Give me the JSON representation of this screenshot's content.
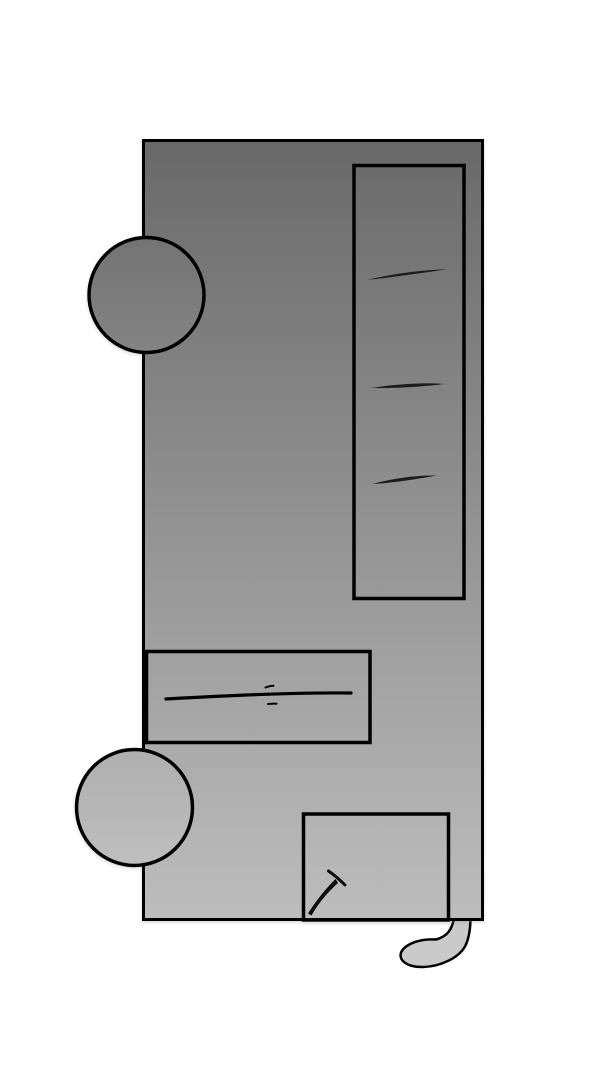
{
  "canvas": {
    "width": 600,
    "height": 1080,
    "background": "#ffffff"
  },
  "palette": {
    "outline": "#000000",
    "shadow_color": "#888888"
  },
  "parts": {
    "body": {
      "x": 143.5,
      "y": 140.5,
      "width": 339,
      "height": 779,
      "stroke_width": 3,
      "fill_top": "#696969",
      "fill_bottom": "#bdbdbd"
    },
    "display_window": {
      "x": 354,
      "y": 165.5,
      "width": 110,
      "height": 433,
      "stroke_width": 3.5,
      "fill": "none"
    },
    "shelf_marks": {
      "color": "#1a1a1a",
      "paths": [
        "M 367 280 C 392 274 423 269.5 447 269.5 C 423 272.5 392 277.5 367 280 Z",
        "M 371 388 C 397 384 426 382.5 444 384 C 425 386.5 396 388.5 371 388 Z",
        "M 372 484 C 392 478.5 417 475 437 475.5 C 417 479 393 483 372 484 Z"
      ]
    },
    "slot_panel": {
      "x": 146.5,
      "y": 651.5,
      "width": 223.5,
      "height": 91,
      "stroke_width": 3.5,
      "fill": "none",
      "line_path": "M 166 699 C 235 695 305 692.5 351 693",
      "line_width": 3.2,
      "tick_top_path": "M 265.5 687.5 C 268.5 686.3 271.5 685.7 273.5 685.7",
      "tick_bottom_path": "M 268 704 C 271 703.7 274 703.4 276.5 703.7",
      "tick_width": 2
    },
    "hatch": {
      "x": 303.5,
      "y": 814,
      "width": 145,
      "height": 106,
      "stroke_width": 3.5,
      "fill": "none"
    },
    "pushpin": {
      "color": "#0a0a0a",
      "body_path": "M 308 913.5 C 316.5 900 326 888.5 335.5 879 C 336.5 880.5 337.5 882 338 883 C 329.5 890.5 319 902 311.5 915.5 Z",
      "head_path": "M 328.5 871 C 333.5 874.5 339.5 879.5 345 885",
      "head_width": 3
    },
    "knob_top": {
      "cx": 146.5,
      "cy": 295,
      "r": 57.5,
      "stroke_width": 3.5,
      "fill_top": "#737373",
      "fill_bottom": "#848484"
    },
    "knob_bottom": {
      "cx": 134.5,
      "cy": 807.5,
      "r": 58,
      "stroke_width": 3.5,
      "fill_top": "#aeaeae",
      "fill_bottom": "#bfbfbf"
    },
    "tail": {
      "path": "M 454 918 C 452 930 447 936.5 436 939.5 C 419 938.5 406 944 401.5 951.5 C 397.5 960 407 967.5 423 967 C 441 966.5 459.5 957.5 465.5 945.5 C 469 938 470.5 929 470.5 917 Z",
      "fill": "#cacaca",
      "stroke_width": 2.5
    }
  }
}
